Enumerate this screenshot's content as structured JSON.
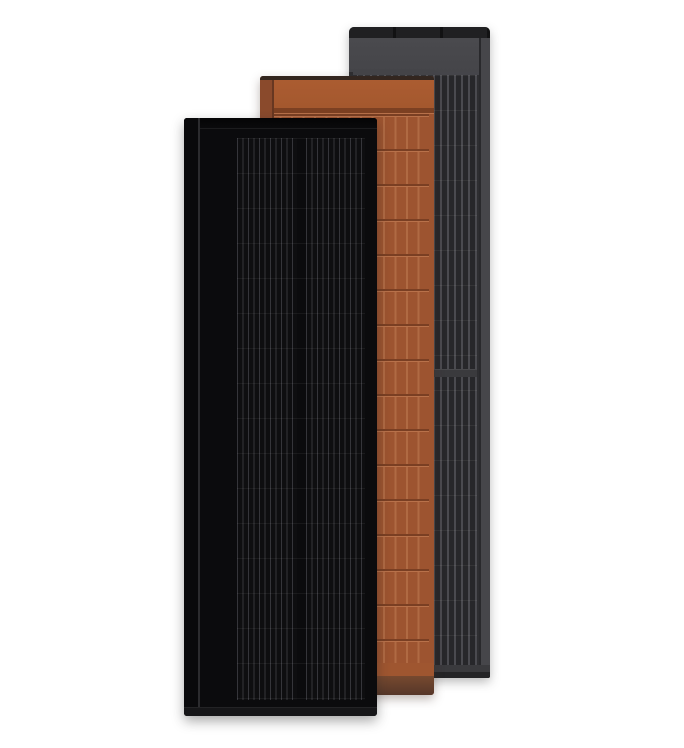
{
  "scene": {
    "title": "Product render: three overlapping vertical solar roof panels",
    "background": "#ffffff"
  },
  "panels": [
    {
      "id": "gray",
      "label": "Dark gray solar panel (back)"
    },
    {
      "id": "terracotta",
      "label": "Terracotta solar panel (middle)"
    },
    {
      "id": "black",
      "label": "Black solar panel (front)"
    }
  ],
  "colors": {
    "bg": "#ffffff",
    "gray-top-strip": "#202022",
    "gray-header": "#454549",
    "gray-hairline": "#5a5a5e",
    "gray-cell-bg": "#2e2e31",
    "gray-cell-stripe": "#27272a",
    "gray-cell-line": "#4a4a4f",
    "gray-rail": "#46464a",
    "gray-bottom-band": "#3a3a3d",
    "gray-bottom-strip": "#242426",
    "terra-top-strip": "#33261f",
    "terra-header": "#a4582e",
    "terra-groove": "#7c4022",
    "terra-cell-bg": "#9d5430",
    "terra-cell-line": "#b06a43",
    "terra-row-line": "#7a3f23",
    "terra-row-glint": "#b8714a",
    "terra-bottom-band": "#9f5630",
    "terra-bottom-top": "#77492f",
    "terra-bottom-bot": "#563729",
    "terra-rail": "#6b4234",
    "black-body": "#0b0b0d",
    "black-frame": "#040405",
    "black-seam": "#2b2b2e",
    "black-cell-bg": "#0e0e10",
    "black-cell-line": "#35353a",
    "black-row-line": "#1f1f22",
    "black-bottom-strip": "#161618"
  }
}
